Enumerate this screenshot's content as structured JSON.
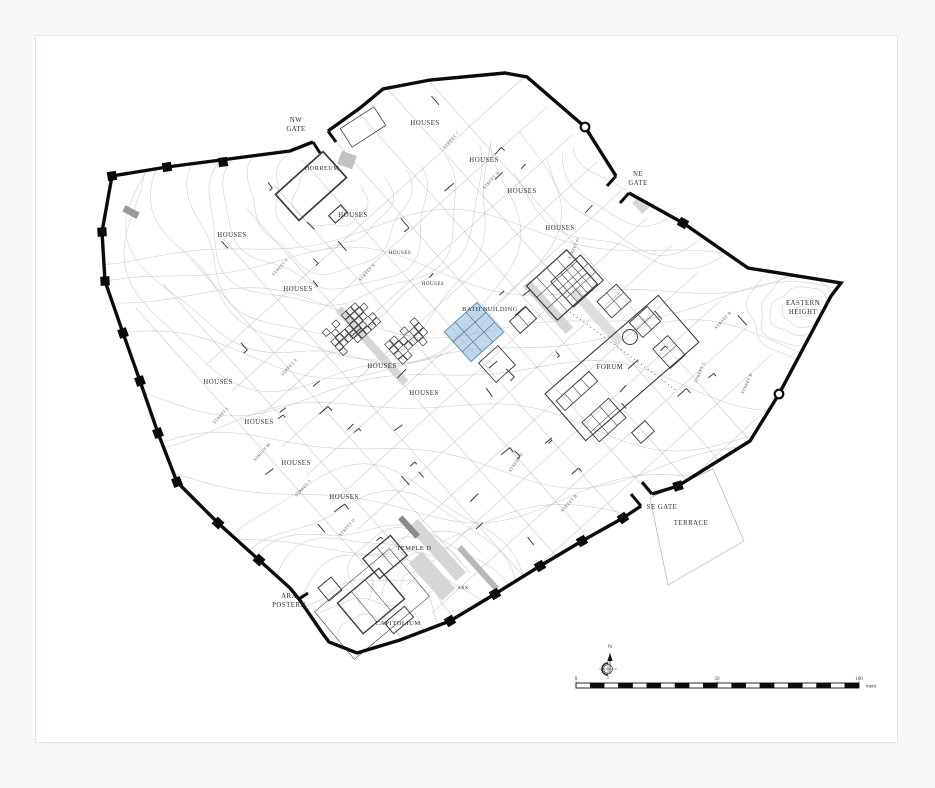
{
  "page": {
    "background": "#f6f7f7",
    "paper": "#ffffff",
    "paper_border": "#e3e5e5",
    "paper_rect": [
      35,
      35,
      861,
      706
    ]
  },
  "map": {
    "description": "Archaeological town plan with circuit wall, contours, street grid and excavated buildings",
    "colors": {
      "wall": "#0b0b0b",
      "contour": "#cbcbcb",
      "street": "#a2a2a2",
      "building": "#3b3b3b",
      "gray_fill": "#d6d6d6",
      "label": "#2e2e2e",
      "street_label": "#4a4a4a",
      "highlight_fill": "#8fb8d8",
      "highlight_stroke": "#5d8fb5",
      "terrace_line": "#b3b3b3"
    },
    "wall": {
      "stroke_width": 3.4,
      "segments": [
        [
          [
            313,
            142
          ],
          [
            290,
            151
          ],
          [
            167,
            167
          ],
          [
            112,
            176
          ],
          [
            102,
            232
          ],
          [
            105,
            281
          ],
          [
            123,
            333
          ],
          [
            140,
            381
          ],
          [
            158,
            433
          ],
          [
            177,
            482
          ],
          [
            218,
            523
          ],
          [
            259,
            560
          ],
          [
            290,
            588
          ],
          [
            299,
            599
          ],
          [
            323,
            634
          ],
          [
            329,
            642
          ],
          [
            357,
            653
          ],
          [
            400,
            640
          ],
          [
            450,
            621
          ],
          [
            495,
            594
          ],
          [
            540,
            566
          ],
          [
            582,
            541
          ],
          [
            623,
            518
          ],
          [
            641,
            506
          ]
        ],
        [
          [
            652,
            494
          ],
          [
            678,
            486
          ],
          [
            750,
            441
          ],
          [
            779,
            394
          ],
          [
            831,
            296
          ],
          [
            841,
            283
          ],
          [
            748,
            268
          ],
          [
            683,
            223
          ],
          [
            629,
            193
          ]
        ],
        [
          [
            616,
            176
          ],
          [
            585,
            127
          ],
          [
            527,
            77
          ],
          [
            505,
            73
          ],
          [
            430,
            80
          ],
          [
            383,
            89
          ],
          [
            360,
            108
          ],
          [
            328,
            131
          ]
        ]
      ],
      "towers": [
        [
          223,
          162
        ],
        [
          167,
          167
        ],
        [
          112,
          176
        ],
        [
          102,
          232
        ],
        [
          105,
          281
        ],
        [
          123,
          333
        ],
        [
          140,
          381
        ],
        [
          158,
          433
        ],
        [
          177,
          482
        ],
        [
          218,
          523
        ],
        [
          259,
          560
        ],
        [
          450,
          621
        ],
        [
          495,
          594
        ],
        [
          540,
          566
        ],
        [
          582,
          541
        ],
        [
          623,
          518
        ],
        [
          678,
          486
        ],
        [
          683,
          223
        ]
      ],
      "ring_towers": [
        [
          585,
          127
        ],
        [
          779,
          394
        ]
      ],
      "gate_stubs": [
        [
          [
            313,
            142
          ],
          [
            320,
            153
          ]
        ],
        [
          [
            328,
            131
          ],
          [
            336,
            142
          ]
        ],
        [
          [
            629,
            193
          ],
          [
            620,
            203
          ]
        ],
        [
          [
            616,
            176
          ],
          [
            607,
            186
          ]
        ],
        [
          [
            641,
            506
          ],
          [
            631,
            494
          ]
        ],
        [
          [
            652,
            494
          ],
          [
            642,
            482
          ]
        ],
        [
          [
            299,
            599
          ],
          [
            308,
            593
          ]
        ]
      ]
    },
    "labels": [
      {
        "lines": [
          "NW",
          "GATE"
        ],
        "x": 296,
        "y": 122
      },
      {
        "text": "HOUSES",
        "x": 425,
        "y": 125
      },
      {
        "text": "HOUSES",
        "x": 484,
        "y": 162
      },
      {
        "text": "HOUSES",
        "x": 522,
        "y": 193
      },
      {
        "text": "HORREUM",
        "x": 322,
        "y": 170,
        "size": 6.2
      },
      {
        "lines": [
          "NE",
          "GATE"
        ],
        "x": 638,
        "y": 176
      },
      {
        "text": "HOUSES",
        "x": 560,
        "y": 230
      },
      {
        "text": "HOUSES",
        "x": 353,
        "y": 217
      },
      {
        "text": "HOUSES",
        "x": 232,
        "y": 237
      },
      {
        "text": "HOUSES",
        "x": 400,
        "y": 254,
        "size": 5
      },
      {
        "text": "HOUSES",
        "x": 433,
        "y": 285,
        "size": 5
      },
      {
        "text": "HOUSES",
        "x": 298,
        "y": 291
      },
      {
        "text": "BATH BUILDING",
        "x": 490,
        "y": 311,
        "size": 6.4
      },
      {
        "lines": [
          "EASTERN",
          "HEIGHT"
        ],
        "x": 803,
        "y": 305
      },
      {
        "text": "FORUM",
        "x": 610,
        "y": 369
      },
      {
        "text": "HOUSES",
        "x": 382,
        "y": 368
      },
      {
        "text": "HOUSES",
        "x": 218,
        "y": 384
      },
      {
        "text": "HOUSES",
        "x": 424,
        "y": 395
      },
      {
        "text": "HOUSES",
        "x": 259,
        "y": 424
      },
      {
        "text": "HOUSES",
        "x": 296,
        "y": 465
      },
      {
        "text": "HOUSES",
        "x": 344,
        "y": 499
      },
      {
        "text": "SE GATE",
        "x": 662,
        "y": 509
      },
      {
        "text": "TERRACE",
        "x": 691,
        "y": 525
      },
      {
        "text": "TEMPLE D",
        "x": 414,
        "y": 550,
        "size": 6.4
      },
      {
        "text": "ARX",
        "x": 463,
        "y": 589,
        "size": 4.6
      },
      {
        "lines": [
          "ARX",
          "POSTERN"
        ],
        "x": 289,
        "y": 598
      },
      {
        "text": "CAPITOLIUM",
        "x": 398,
        "y": 625,
        "size": 6.6
      }
    ],
    "street_labels": [
      {
        "text": "STREET 7",
        "x": 452,
        "y": 141,
        "rot": -48
      },
      {
        "text": "STREET N",
        "x": 492,
        "y": 181,
        "rot": -48
      },
      {
        "text": "STREET 6",
        "x": 281,
        "y": 268,
        "rot": -48
      },
      {
        "text": "STREET N",
        "x": 368,
        "y": 273,
        "rot": -48
      },
      {
        "text": "STREET O",
        "x": 575,
        "y": 249,
        "rot": -66
      },
      {
        "text": "STREET 4",
        "x": 290,
        "y": 368,
        "rot": -48
      },
      {
        "text": "STREET L",
        "x": 222,
        "y": 416,
        "rot": -48
      },
      {
        "text": "STREET M",
        "x": 263,
        "y": 453,
        "rot": -48
      },
      {
        "text": "STREET 5",
        "x": 304,
        "y": 489,
        "rot": -48
      },
      {
        "text": "STREET O",
        "x": 348,
        "y": 528,
        "rot": -48
      },
      {
        "text": "STREET D",
        "x": 517,
        "y": 463,
        "rot": -56
      },
      {
        "text": "STREET B",
        "x": 570,
        "y": 504,
        "rot": -48
      },
      {
        "text": "STREET 5",
        "x": 701,
        "y": 373,
        "rot": -66
      },
      {
        "text": "STREET B",
        "x": 724,
        "y": 321,
        "rot": -48
      },
      {
        "text": "STREET B",
        "x": 748,
        "y": 384,
        "rot": -66
      }
    ],
    "streets": [
      [
        357,
        111,
        705,
        501
      ],
      [
        330,
        135,
        657,
        502
      ],
      [
        302,
        160,
        630,
        528
      ],
      [
        274,
        185,
        602,
        553
      ],
      [
        247,
        209,
        575,
        577
      ],
      [
        219,
        234,
        525,
        578
      ],
      [
        191,
        259,
        470,
        573
      ],
      [
        163,
        284,
        419,
        572
      ],
      [
        136,
        308,
        365,
        565
      ],
      [
        385,
        86,
        733,
        476
      ],
      [
        412,
        62,
        760,
        452
      ],
      [
        622,
        190,
        307,
        475
      ],
      [
        597,
        162,
        282,
        447
      ],
      [
        572,
        135,
        257,
        419
      ],
      [
        547,
        107,
        232,
        391
      ],
      [
        522,
        79,
        207,
        364
      ],
      [
        647,
        218,
        332,
        503
      ],
      [
        672,
        245,
        357,
        530
      ],
      [
        697,
        273,
        382,
        558
      ],
      [
        721,
        300,
        407,
        585
      ],
      [
        746,
        328,
        432,
        613
      ],
      [
        771,
        355,
        457,
        640
      ],
      [
        796,
        383,
        482,
        668
      ]
    ],
    "gray_areas": [
      {
        "cx": 372,
        "cy": 346,
        "w": 100,
        "h": 8,
        "rot": 48
      },
      {
        "cx": 548,
        "cy": 307,
        "w": 64,
        "h": 10,
        "rot": 48
      },
      {
        "cx": 597,
        "cy": 316,
        "w": 70,
        "h": 9,
        "rot": 48,
        "fill": "#dedede"
      },
      {
        "cx": 437,
        "cy": 550,
        "w": 72,
        "h": 13,
        "rot": 48
      },
      {
        "cx": 432,
        "cy": 576,
        "w": 50,
        "h": 18,
        "rot": 48
      },
      {
        "cx": 478,
        "cy": 568,
        "w": 56,
        "h": 6,
        "rot": 48,
        "fill": "#b8b8b8"
      },
      {
        "cx": 409,
        "cy": 527,
        "w": 26,
        "h": 6,
        "rot": 48,
        "fill": "#8a8a8a"
      },
      {
        "cx": 641,
        "cy": 205,
        "w": 15,
        "h": 10,
        "rot": 48
      },
      {
        "cx": 347,
        "cy": 160,
        "w": 16,
        "h": 14,
        "rot": 20,
        "fill": "#c2c2c2"
      },
      {
        "cx": 131,
        "cy": 212,
        "w": 16,
        "h": 7,
        "rot": 28,
        "fill": "#9a9a9a"
      }
    ],
    "buildings": {
      "rects": [
        {
          "cx": 311,
          "cy": 186,
          "w": 64,
          "h": 35,
          "rot": -42,
          "lw": 1.7
        },
        {
          "cx": 338,
          "cy": 214,
          "w": 16,
          "h": 10,
          "rot": -42,
          "lw": 1.1
        },
        {
          "cx": 363,
          "cy": 127,
          "w": 40,
          "h": 22,
          "rot": -33,
          "lw": 0.8
        },
        {
          "cx": 562,
          "cy": 285,
          "w": 54,
          "h": 46,
          "rot": -42,
          "grid": [
            4,
            3
          ],
          "lw": 1.2
        },
        {
          "cx": 523,
          "cy": 320,
          "w": 22,
          "h": 16,
          "rot": -42,
          "grid": [
            2,
            1
          ],
          "lw": 0.9
        },
        {
          "cx": 497,
          "cy": 364,
          "w": 26,
          "h": 26,
          "rot": -42,
          "lw": 0.9
        },
        {
          "cx": 622,
          "cy": 368,
          "w": 150,
          "h": 62,
          "rot": -41,
          "lw": 1.1
        },
        {
          "cx": 577,
          "cy": 281,
          "w": 40,
          "h": 34,
          "rot": -42,
          "grid": [
            3,
            3
          ],
          "lw": 1.0
        },
        {
          "cx": 614,
          "cy": 301,
          "w": 26,
          "h": 22,
          "rot": -42,
          "grid": [
            2,
            2
          ],
          "lw": 0.9
        },
        {
          "cx": 645,
          "cy": 322,
          "w": 24,
          "h": 20,
          "rot": -42,
          "grid": [
            2,
            2
          ],
          "lw": 0.9
        },
        {
          "cx": 669,
          "cy": 352,
          "w": 20,
          "h": 26,
          "rot": -42,
          "grid": [
            1,
            2
          ],
          "lw": 0.9
        },
        {
          "cx": 604,
          "cy": 420,
          "w": 36,
          "h": 26,
          "rot": -42,
          "grid": [
            3,
            2
          ],
          "lw": 0.9
        },
        {
          "cx": 643,
          "cy": 432,
          "w": 18,
          "h": 14,
          "rot": -42,
          "lw": 0.9
        },
        {
          "cx": 577,
          "cy": 391,
          "w": 44,
          "h": 13,
          "rot": -42,
          "grid": [
            4,
            1
          ],
          "lw": 0.9
        },
        {
          "cx": 385,
          "cy": 557,
          "w": 36,
          "h": 26,
          "rot": -40,
          "grid": [
            2,
            1
          ],
          "lw": 1.3
        },
        {
          "cx": 371,
          "cy": 601,
          "w": 54,
          "h": 40,
          "rot": -40,
          "grid": [
            3,
            1
          ],
          "lw": 1.4
        },
        {
          "cx": 399,
          "cy": 620,
          "w": 26,
          "h": 14,
          "rot": -40,
          "lw": 1.0
        },
        {
          "cx": 330,
          "cy": 589,
          "w": 17,
          "h": 17,
          "rot": -40,
          "grid": [
            1,
            1
          ],
          "lw": 1.0
        },
        {
          "cx": 372,
          "cy": 604,
          "w": 98,
          "h": 62,
          "rot": -40,
          "lw": 0.6
        }
      ],
      "clusters": [
        {
          "cx": 352,
          "cy": 327,
          "cols": 8,
          "rows": 5,
          "cell": 6.4,
          "rot": -42,
          "seed": 3
        },
        {
          "cx": 409,
          "cy": 341,
          "cols": 6,
          "rows": 4,
          "cell": 6.8,
          "rot": -42,
          "seed": 5
        }
      ],
      "circles": [
        {
          "x": 630,
          "y": 337,
          "r": 7.5
        }
      ],
      "dotted_lines": [
        [
          570,
          312,
          676,
          390
        ]
      ]
    },
    "highlight": {
      "cx": 474,
      "cy": 332,
      "w": 44,
      "h": 40,
      "rot": -42,
      "grid": [
        3,
        3
      ]
    },
    "terrace_outline": [
      [
        650,
        498
      ],
      [
        713,
        469
      ],
      [
        744,
        541
      ],
      [
        668,
        585
      ]
    ],
    "fragments": {
      "zones": [
        [
          200,
          175,
          270,
          125
        ],
        [
          215,
          330,
          210,
          160
        ],
        [
          380,
          295,
          190,
          150
        ],
        [
          420,
          85,
          180,
          130
        ],
        [
          610,
          300,
          130,
          110
        ],
        [
          240,
          430,
          180,
          120
        ],
        [
          430,
          430,
          160,
          110
        ]
      ],
      "per_zone": 8,
      "seed": 11
    },
    "contours": {
      "families": [
        {
          "type": "arc",
          "cx": 330,
          "cy": 195,
          "rmin": 36,
          "rmax": 210,
          "n": 9,
          "a0": -20,
          "a1": 230,
          "ey": 0.92
        },
        {
          "type": "arc",
          "cx": 368,
          "cy": 648,
          "rmin": 35,
          "rmax": 185,
          "n": 8,
          "a0": 185,
          "a1": 355,
          "ey": 0.9
        },
        {
          "type": "arc",
          "cx": 802,
          "cy": 312,
          "rmin": 7,
          "rmax": 55,
          "n": 5,
          "a0": 0,
          "a1": 360,
          "ey": 0.78
        },
        {
          "type": "arc",
          "cx": 655,
          "cy": 115,
          "rmin": 35,
          "rmax": 150,
          "n": 6,
          "a0": 20,
          "a1": 160,
          "ey": 1
        },
        {
          "type": "arc",
          "cx": 420,
          "cy": 585,
          "rmin": 18,
          "rmax": 70,
          "n": 4,
          "a0": 160,
          "a1": 330,
          "ey": 0.85
        },
        {
          "type": "wave",
          "x0": 95,
          "x1": 845,
          "y0": 240,
          "y1": 530,
          "n": 9,
          "amp": 22
        }
      ]
    },
    "north_arrow": {
      "x": 610,
      "y": 648,
      "label": "N"
    },
    "scale_bar": {
      "x0": 576,
      "x1": 859,
      "y": 688,
      "h": 5,
      "segments": 20,
      "tick_labels": [
        {
          "t": "0",
          "x": 576
        },
        {
          "t": "50",
          "x": 717
        },
        {
          "t": "100",
          "x": 859
        }
      ],
      "unit": "metri"
    }
  }
}
